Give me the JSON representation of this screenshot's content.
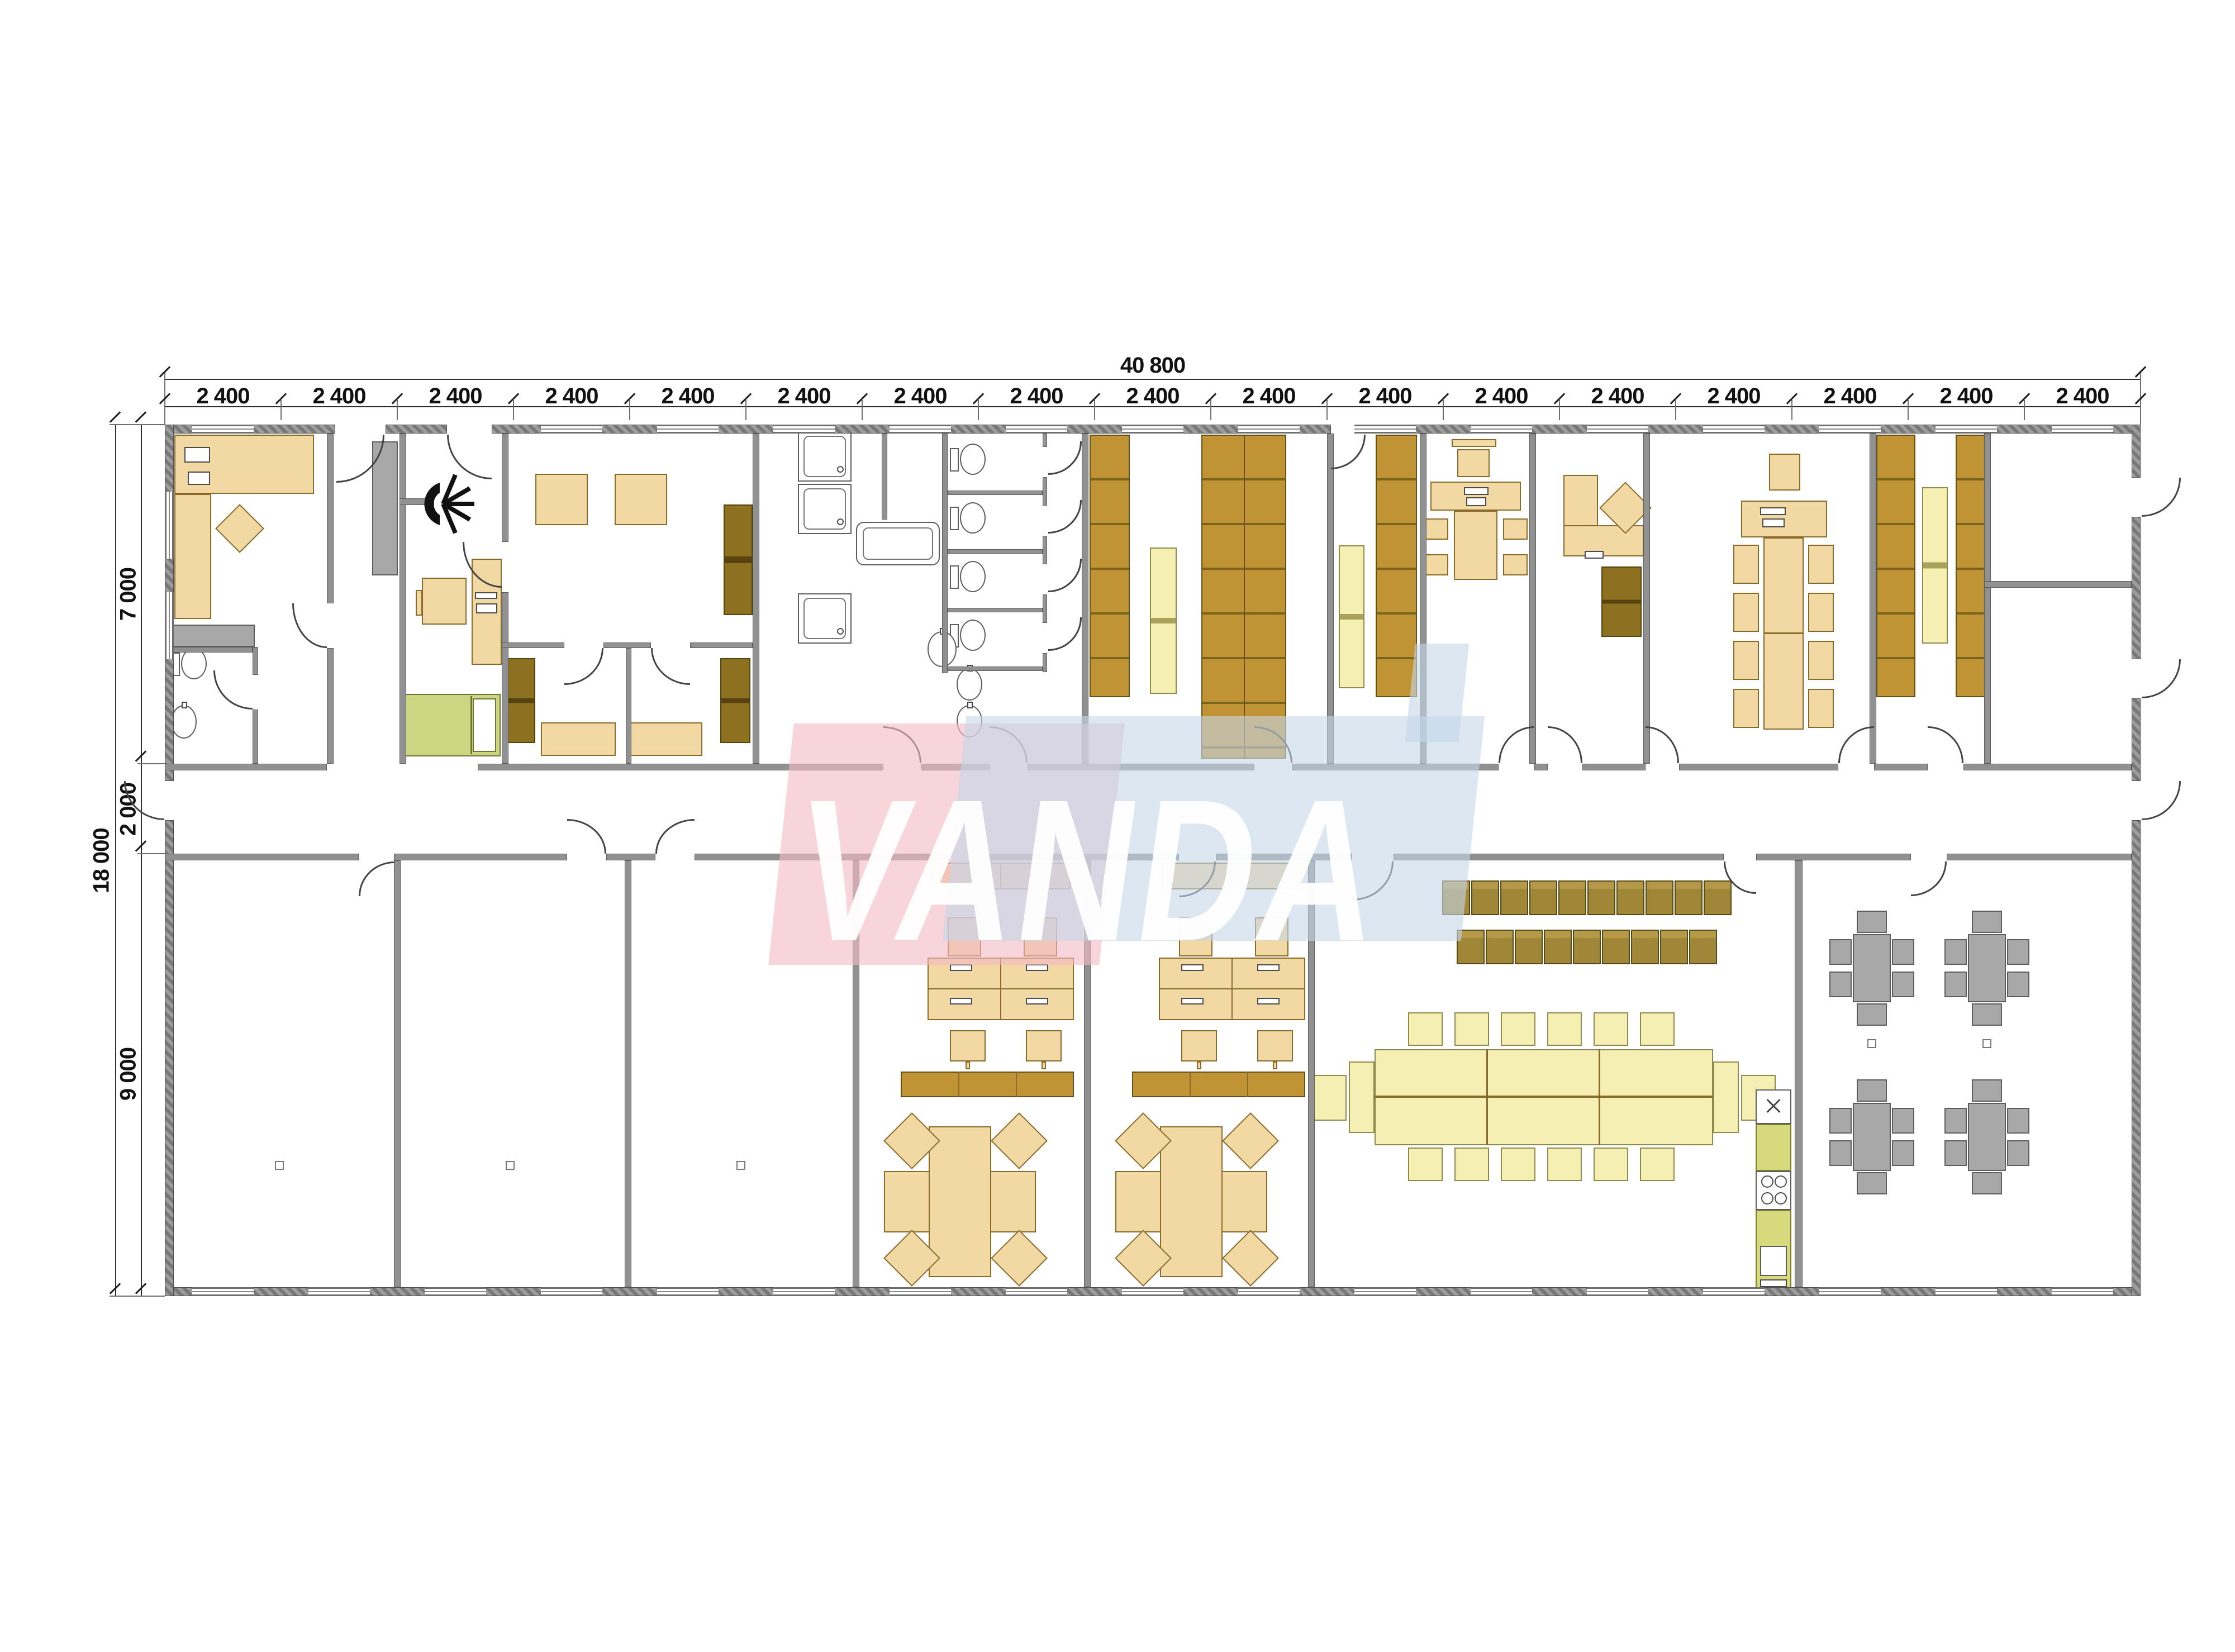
{
  "watermark": {
    "text": "VANDA",
    "pink_color": "#f4bac5",
    "blue_color": "#c4d7e9"
  },
  "dimensions": {
    "top_total_label": "40 800",
    "top_module_label": "2 400",
    "top_module_count": 17,
    "left_total_label": "18 000",
    "left_segment_labels": [
      "7 000",
      "2 000",
      "9 000"
    ]
  },
  "furniture_counts": {
    "training_chair_rows": [
      10,
      9
    ],
    "long_table_chairs_per_side": 6,
    "meeting_table_chairs_per_side": 4,
    "canteen_tables": 4,
    "canteen_chairs_per_table": 6,
    "wc_stalls": 4,
    "shower_stalls": 3,
    "workstation_clusters": 2
  },
  "colors": {
    "wall": "#8f8f8f",
    "desk_tan": "#f2d8a2",
    "shelf_gold": "#c09434",
    "sofa_brown": "#8e7120",
    "bench_pale": "#f6efb2",
    "table_gray": "#a8a8a8",
    "bed_green": "#ccd57f",
    "kitchen_green": "#d6da7c"
  }
}
